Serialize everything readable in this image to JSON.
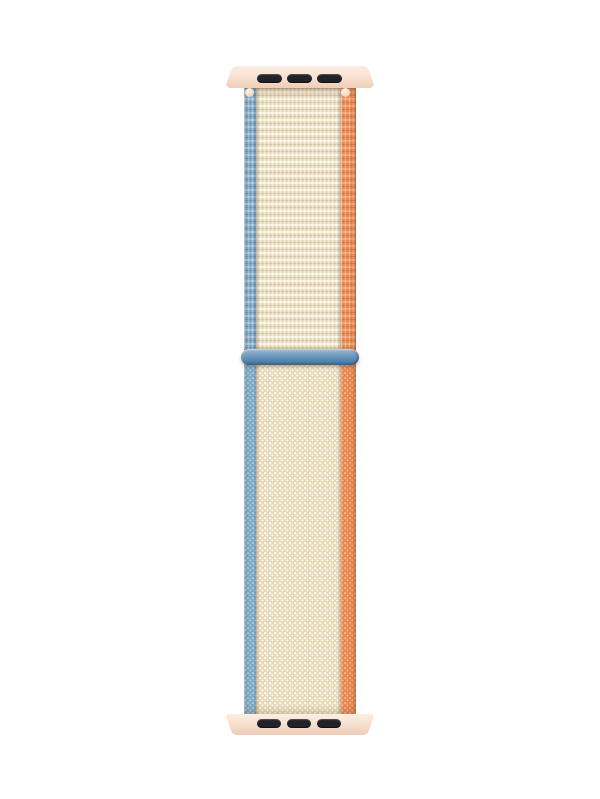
{
  "scene": {
    "type": "product-photo",
    "subject": "Woven nylon sport loop watch band, cream with blue left edge and orange right edge, two pale-pink attachment adapters with three dark slots each, and a blue slider loop across the middle",
    "background_color": "#ffffff"
  },
  "band": {
    "adapter_top": {
      "part": "top adapter lug",
      "color": "#f8e3d3",
      "slot_count": 3,
      "slot_color": "#232228"
    },
    "adapter_bottom": {
      "part": "bottom adapter lug",
      "color": "#f8e3d3",
      "slot_count": 3,
      "slot_color": "#232228"
    },
    "strap": {
      "left_edge_color": "#86afcd",
      "center_color": "#ece1c6",
      "right_edge_color": "#ee8e58",
      "upper_texture": "horizontal woven ribs",
      "lower_texture": "fine loop-pile dot weave"
    },
    "slider_loop": {
      "part": "slider loop ring",
      "color": "#6693ba"
    },
    "pins": {
      "part": "spring-bar pin ends",
      "color": "#f3dcc8"
    }
  },
  "palette": {
    "bg": "#ffffff",
    "lug-light": "#fbeee3",
    "lug-mid": "#f8e3d3",
    "lug-deep": "#f2d6c3",
    "lug-dark": "#eccdb9",
    "slot": "#232228",
    "blue-base": "#86afcd",
    "blue-dark": "#6f9cbd",
    "blue-light": "#a9c8dc",
    "orange-base": "#ee8e58",
    "orange-dark": "#dd7a42",
    "orange-light": "#f7ab7c",
    "cream-base": "#ece1c6",
    "cream-light": "#fbf6e8",
    "cream-dark": "#dbcba6",
    "ring-top": "#a3c1d9",
    "ring-hi": "#7ba3c4",
    "ring-mid": "#6693ba",
    "ring-low": "#527ea6",
    "ring-bottom": "#47729a",
    "pin-light": "#fdf2e6",
    "pin-mid": "#f3dcc8",
    "pin-dark": "#e3c0a4"
  }
}
